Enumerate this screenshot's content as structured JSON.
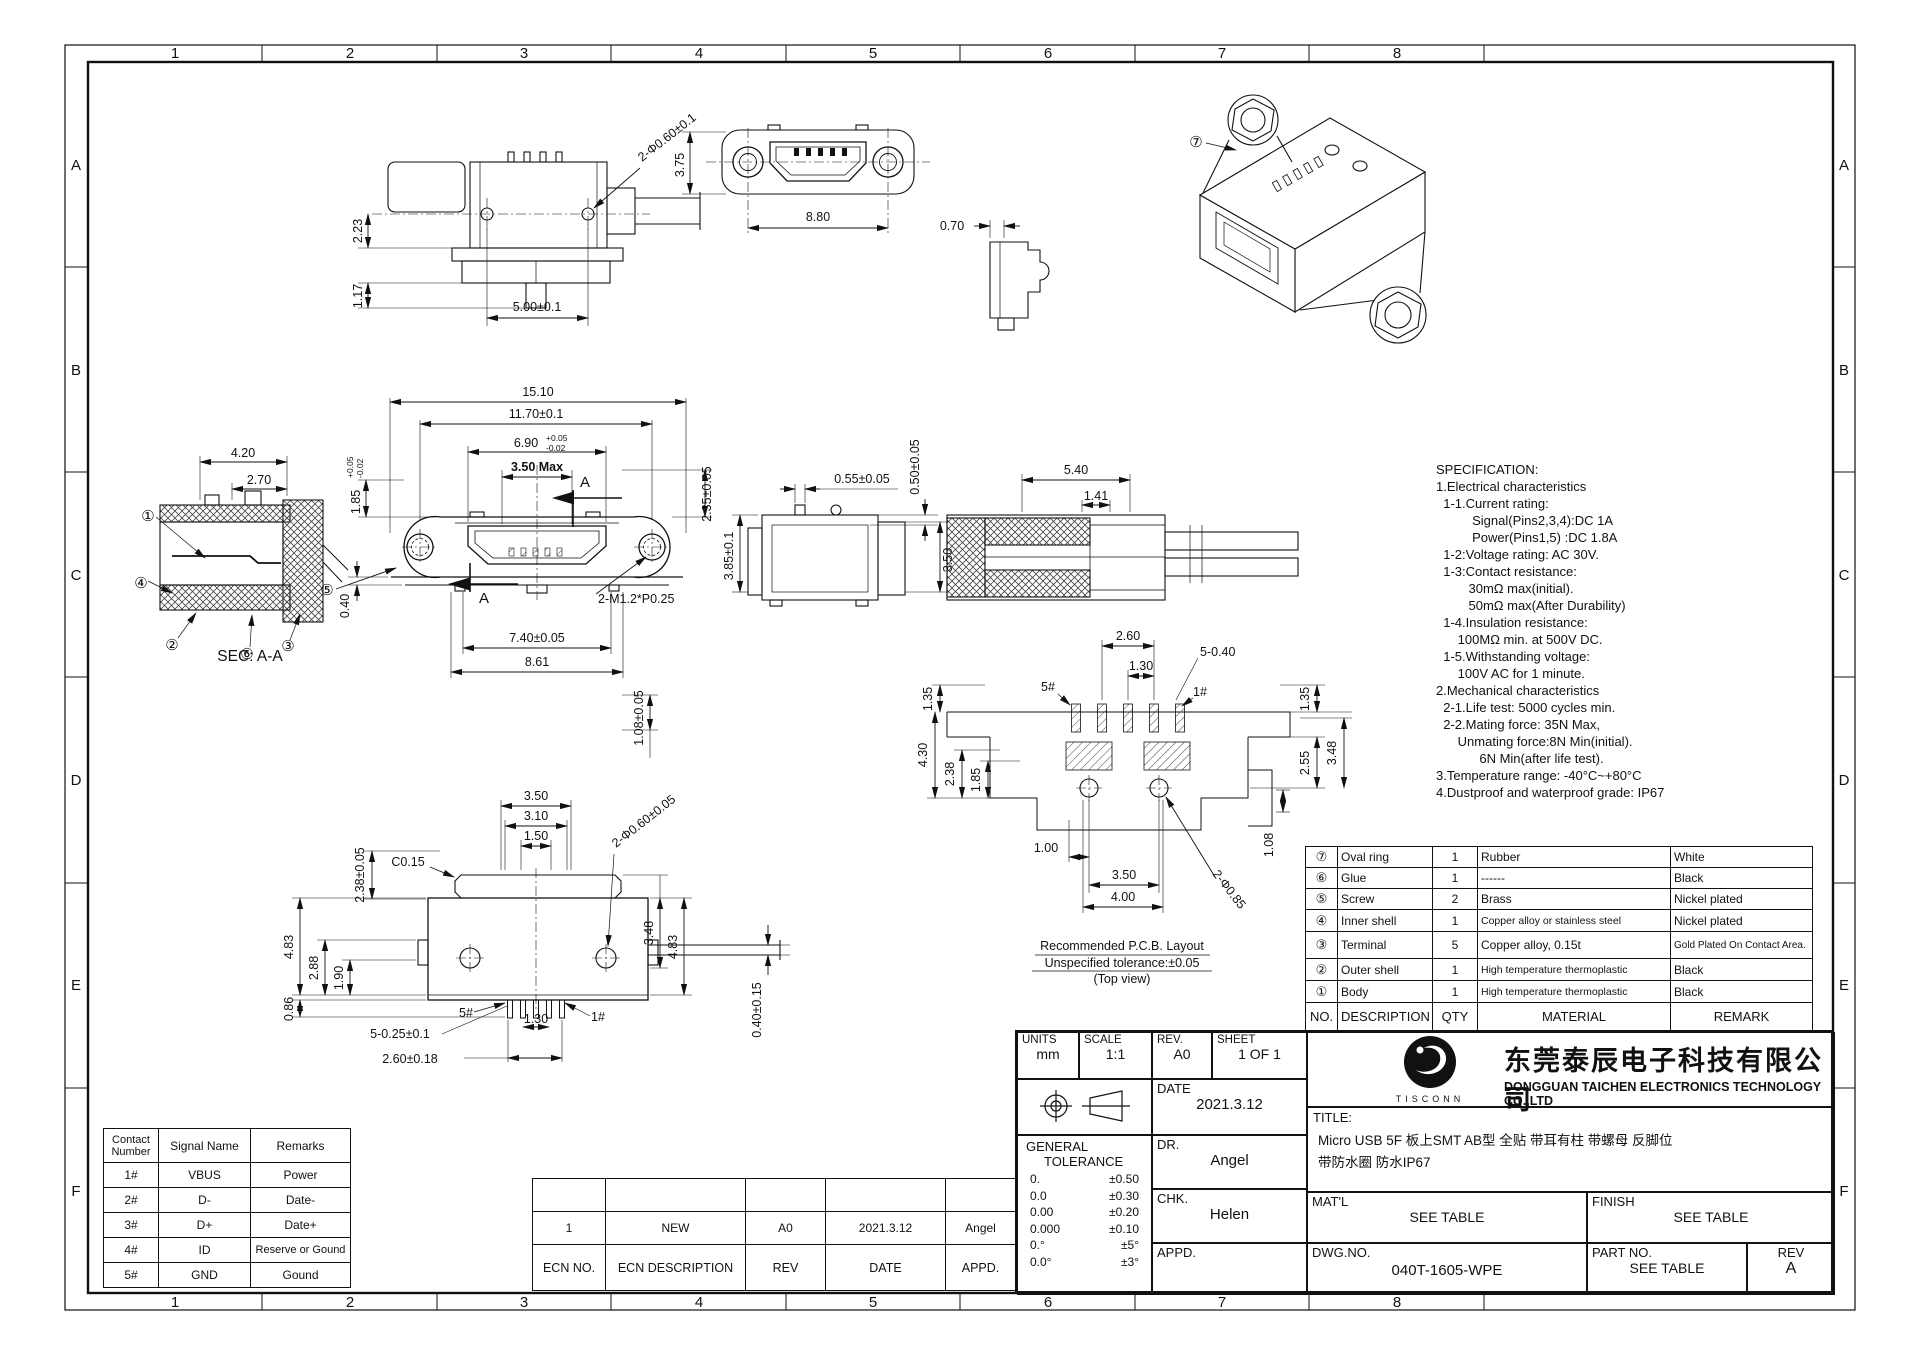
{
  "frame": {
    "cols": [
      "1",
      "2",
      "3",
      "4",
      "5",
      "6",
      "7",
      "8"
    ],
    "rows": [
      "A",
      "B",
      "C",
      "D",
      "E",
      "F"
    ]
  },
  "views": {
    "top": {
      "dims": [
        "2.23",
        "1.17",
        "5.00±0.1",
        "2-Φ0.60±0.1"
      ]
    },
    "front_top": {
      "dims": [
        "3.75",
        "8.80"
      ]
    },
    "side_small": {
      "dims": [
        "0.70"
      ]
    },
    "iso": {
      "refs": [
        "⑦"
      ]
    },
    "sec_aa": {
      "caption": "SEC: A-A",
      "dims": [
        "4.20",
        "2.70"
      ],
      "refs": [
        "①",
        "④",
        "②",
        "⑥",
        "③"
      ]
    },
    "front_main": {
      "dims": [
        "15.10",
        "11.70±0.1",
        "6.90",
        "+0.05",
        "-0.02",
        "3.50 Max",
        "1.85",
        "+0.05",
        "-0.02",
        "2.35±0.05",
        "0.40",
        "7.40±0.05",
        "8.61",
        "2-M1.2*P0.25",
        "1.08±0.05"
      ],
      "refs": [
        "⑤"
      ],
      "section_label": "A"
    },
    "side_mid": {
      "dims": [
        "0.55±0.05",
        "0.50±0.05",
        "3.85±0.1",
        "3.50"
      ]
    },
    "side_sect": {
      "dims": [
        "5.40",
        "1.41"
      ]
    },
    "pcb": {
      "dims": [
        "2.60",
        "1.30",
        "5-0.40",
        "1.35",
        "4.30",
        "2.38",
        "1.85",
        "1.35",
        "2.55",
        "3.48",
        "1.08",
        "1.00",
        "3.50",
        "4.00",
        "2-Φ0.85"
      ],
      "pins": [
        "5#",
        "1#"
      ],
      "captions": [
        "Recommended P.C.B. Layout",
        "Unspecified tolerance:±0.05",
        "(Top view)"
      ]
    },
    "bottom": {
      "dims": [
        "3.50",
        "3.10",
        "1.50",
        "C0.15",
        "2-Φ0.60±0.05",
        "2.38±0.05",
        "4.83",
        "2.88",
        "1.90",
        "0.86",
        "3.48",
        "4.83",
        "1.30",
        "5-0.25±0.1",
        "2.60±0.18",
        "0.40±0.15"
      ],
      "pins": [
        "5#",
        "1#"
      ]
    }
  },
  "spec": {
    "lines": [
      "SPECIFICATION:",
      "1.Electrical characteristics",
      "  1-1.Current rating:",
      "          Signal(Pins2,3,4):DC 1A",
      "          Power(Pins1,5) :DC 1.8A",
      "  1-2:Voltage rating: AC 30V.",
      "  1-3:Contact resistance:",
      "         30mΩ max(initial).",
      "         50mΩ max(After Durability)",
      "  1-4.Insulation resistance:",
      "      100MΩ min. at 500V DC.",
      "  1-5.Withstanding voltage:",
      "      100V AC for 1 minute.",
      "2.Mechanical characteristics",
      "  2-1.Life test: 5000 cycles min.",
      "  2-2.Mating force: 35N Max,",
      "      Unmating force:8N Min(initial).",
      "            6N Min(after life test).",
      "3.Temperature range: -40°C~+80°C",
      "4.Dustproof and waterproof grade: IP67"
    ]
  },
  "bom": {
    "headers": {
      "no": "NO.",
      "description": "DESCRIPTION",
      "qty": "QTY",
      "material": "MATERIAL",
      "remark": "REMARK"
    },
    "rows": [
      {
        "no": "⑦",
        "description": "Oval ring",
        "qty": "1",
        "material": "Rubber",
        "remark": "White"
      },
      {
        "no": "⑥",
        "description": "Glue",
        "qty": "1",
        "material": "------",
        "remark": "Black"
      },
      {
        "no": "⑤",
        "description": "Screw",
        "qty": "2",
        "material": "Brass",
        "remark": "Nickel plated"
      },
      {
        "no": "④",
        "description": "Inner shell",
        "qty": "1",
        "material": "Copper alloy or stainless steel",
        "remark": "Nickel plated"
      },
      {
        "no": "③",
        "description": "Terminal",
        "qty": "5",
        "material": "Copper alloy, 0.15t",
        "remark": "Gold Plated On Contact Area."
      },
      {
        "no": "②",
        "description": "Outer shell",
        "qty": "1",
        "material": "High temperature thermoplastic",
        "remark": "Black"
      },
      {
        "no": "①",
        "description": "Body",
        "qty": "1",
        "material": "High temperature thermoplastic",
        "remark": "Black"
      }
    ]
  },
  "title_block": {
    "units_label": "UNITS",
    "units": "mm",
    "scale_label": "SCALE",
    "scale": "1:1",
    "rev_label": "REV.",
    "rev": "A0",
    "sheet_label": "SHEET",
    "sheet": "1 OF 1",
    "date_label": "DATE",
    "date": "2021.3.12",
    "general_tolerance_label_1": "GENERAL",
    "general_tolerance_label_2": "TOLERANCE",
    "tolerances": [
      [
        "0.",
        "±0.50"
      ],
      [
        "0.0",
        "±0.30"
      ],
      [
        "0.00",
        "±0.20"
      ],
      [
        "0.000",
        "±0.10"
      ],
      [
        "0.°",
        "±5°"
      ],
      [
        "0.0°",
        "±3°"
      ]
    ],
    "dr_label": "DR.",
    "dr": "Angel",
    "chk_label": "CHK.",
    "chk": "Helen",
    "appd_label": "APPD.",
    "logo_text": "TISCONN",
    "company_cn": "东莞泰辰电子科技有限公司",
    "company_en": "DONGGUAN TAICHEN ELECTRONICS TECHNOLOGY CO.,LTD",
    "title_label": "TITLE:",
    "title_line1": "Micro USB  5F 板上SMT AB型 全贴 带耳有柱 带螺母 反脚位",
    "title_line2": "带防水圈 防水IP67",
    "matl_label": "MAT'L",
    "matl": "SEE TABLE",
    "finish_label": "FINISH",
    "finish": "SEE TABLE",
    "dwg_label": "DWG.NO.",
    "dwg_no": "040T-1605-WPE",
    "part_label": "PART NO.",
    "part_no": "SEE TABLE",
    "rev2_label": "REV",
    "rev2": "A"
  },
  "ecn": {
    "headers": [
      "ECN NO.",
      "ECN DESCRIPTION",
      "REV",
      "DATE",
      "APPD."
    ],
    "rows": [
      [
        "1",
        "NEW",
        "A0",
        "2021.3.12",
        "Angel"
      ]
    ]
  },
  "contacts": {
    "headers": [
      "Contact Number",
      "Signal Name",
      "Remarks"
    ],
    "rows": [
      [
        "1#",
        "VBUS",
        "Power"
      ],
      [
        "2#",
        "D-",
        "Date-"
      ],
      [
        "3#",
        "D+",
        "Date+"
      ],
      [
        "4#",
        "ID",
        "Reserve or Gound"
      ],
      [
        "5#",
        "GND",
        "Gound"
      ]
    ]
  }
}
